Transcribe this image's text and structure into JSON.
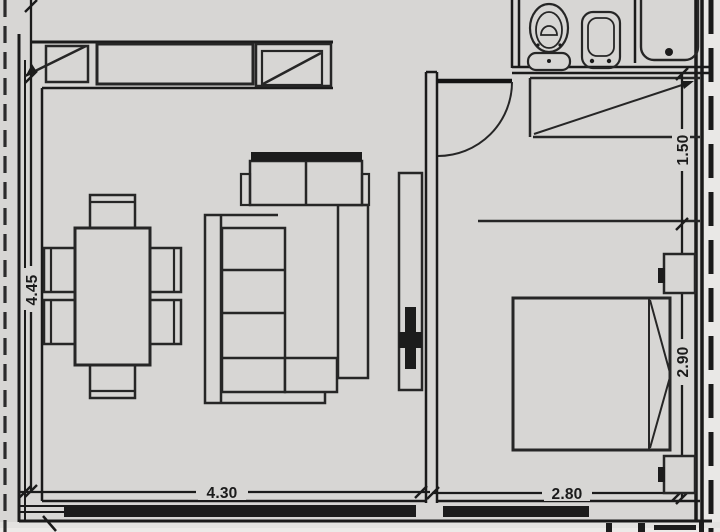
{
  "document": {
    "type": "apartment floor plan",
    "units": "m"
  },
  "dimensions": {
    "living_height": "4.45",
    "living_width": "4.30",
    "bedroom_width": "2.80",
    "closet_depth": "1.50",
    "bedroom_height": "2.90"
  },
  "elements": {
    "living_room": [
      "window-band",
      "dining-table",
      "dining-chairs-x6",
      "sectional-sofa",
      "tv-console"
    ],
    "bedroom": [
      "double-bed",
      "pillows",
      "nightstand-top",
      "nightstand-bottom",
      "closet",
      "shelf-line",
      "swing-door"
    ],
    "bathroom": [
      "toilet",
      "bidet",
      "bathtub"
    ]
  },
  "colors": {
    "paper": "#d7d6d4",
    "paper_light": "#e9e8e6",
    "paper_bottom": "#e3e2e0",
    "line": "#262626",
    "wall": "#1a1a1a",
    "fill_dark": "#1c1c1c",
    "label": "#1b1b1b"
  }
}
